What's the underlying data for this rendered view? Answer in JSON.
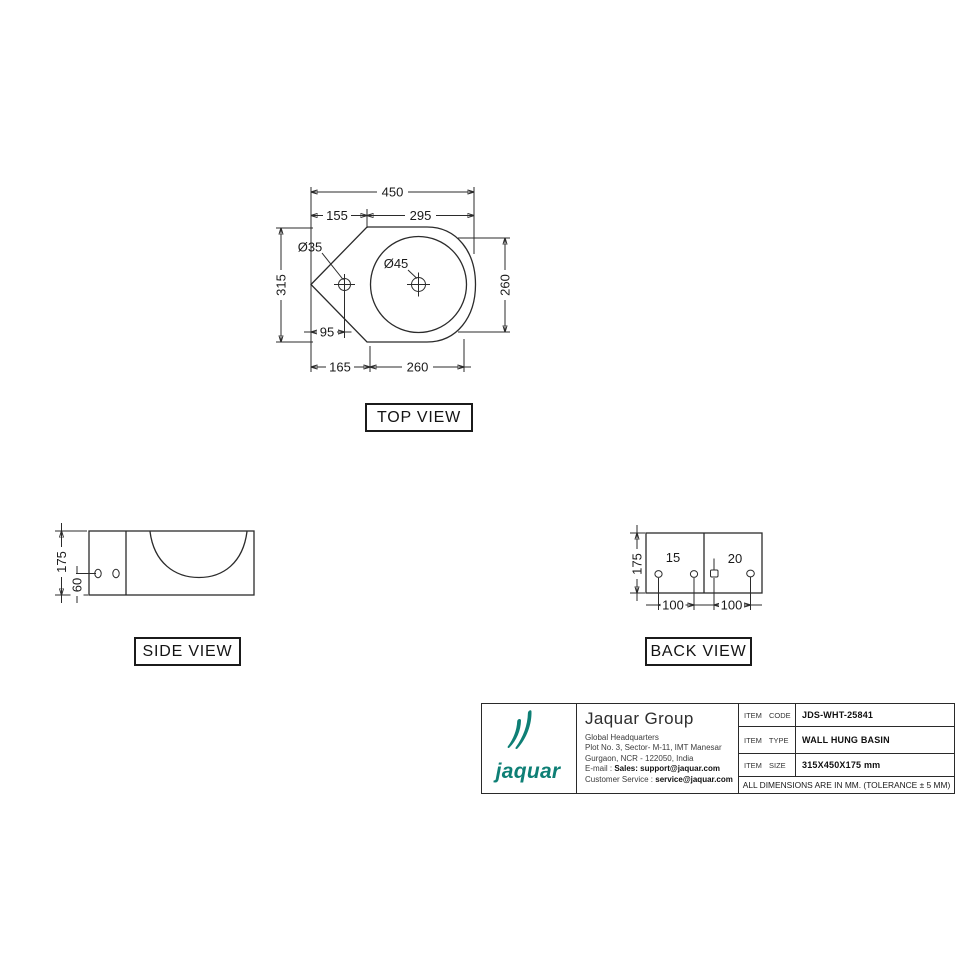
{
  "top_view": {
    "label": "TOP VIEW",
    "dims": {
      "overall_width": "450",
      "left_width": "155",
      "right_width": "295",
      "tap_hole_dia": "Ø35",
      "drain_dia": "Ø45",
      "depth": "315",
      "bowl_height": "260",
      "tap_offset": "95",
      "bowl_left_offset": "165",
      "bowl_width": "260"
    }
  },
  "side_view": {
    "label": "SIDE VIEW",
    "dims": {
      "height": "175",
      "hole_height": "60"
    }
  },
  "back_view": {
    "label": "BACK VIEW",
    "dims": {
      "height": "175",
      "hole_offset_small": "15",
      "hole_offset_large": "20",
      "hole_span_left": "100",
      "hole_span_right": "100"
    }
  },
  "title_block": {
    "brand": {
      "wordmark": "jaquar",
      "color": "#0e7f75"
    },
    "company": {
      "name": "Jaquar Group",
      "address_line1": "Global Headquarters",
      "address_line2": "Plot No. 3, Sector- M-11, IMT Manesar",
      "address_line3": "Gurgaon, NCR - 122050, India",
      "email_label": "E-mail : ",
      "email_value": "Sales: support@jaquar.com",
      "service_label": "Customer Service : ",
      "service_value": "service@jaquar.com"
    },
    "table": {
      "rows": [
        {
          "label": "ITEM CODE",
          "value": "JDS-WHT-25841"
        },
        {
          "label": "ITEM TYPE",
          "value": "WALL HUNG BASIN"
        },
        {
          "label": "ITEM SIZE",
          "value": "315X450X175 mm"
        }
      ],
      "note": "ALL DIMENSIONS ARE IN MM. (TOLERANCE ± 5 MM)"
    }
  }
}
